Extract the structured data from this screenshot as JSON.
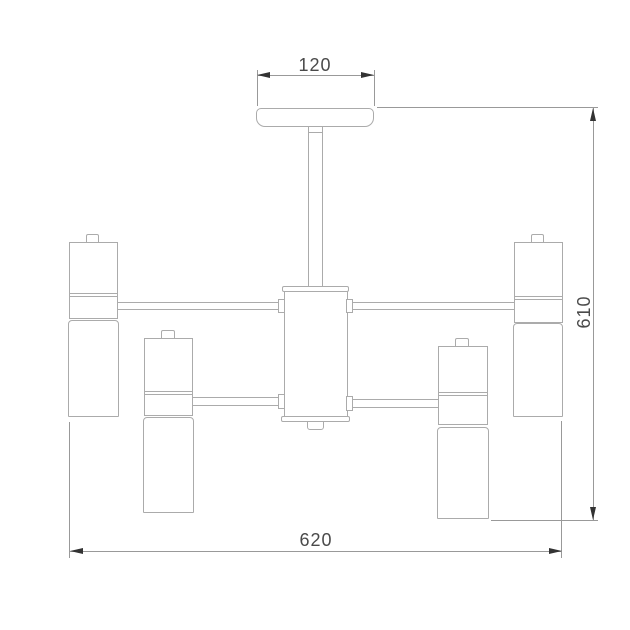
{
  "drawing": {
    "dimensions": {
      "canopy_width": "120",
      "fixture_width": "620",
      "fixture_height": "610"
    },
    "colors": {
      "background": "#ffffff",
      "outline": "#ababab",
      "dimension_line": "#999999",
      "dimension_text": "#4a4a4a",
      "arrow": "#333333"
    }
  }
}
